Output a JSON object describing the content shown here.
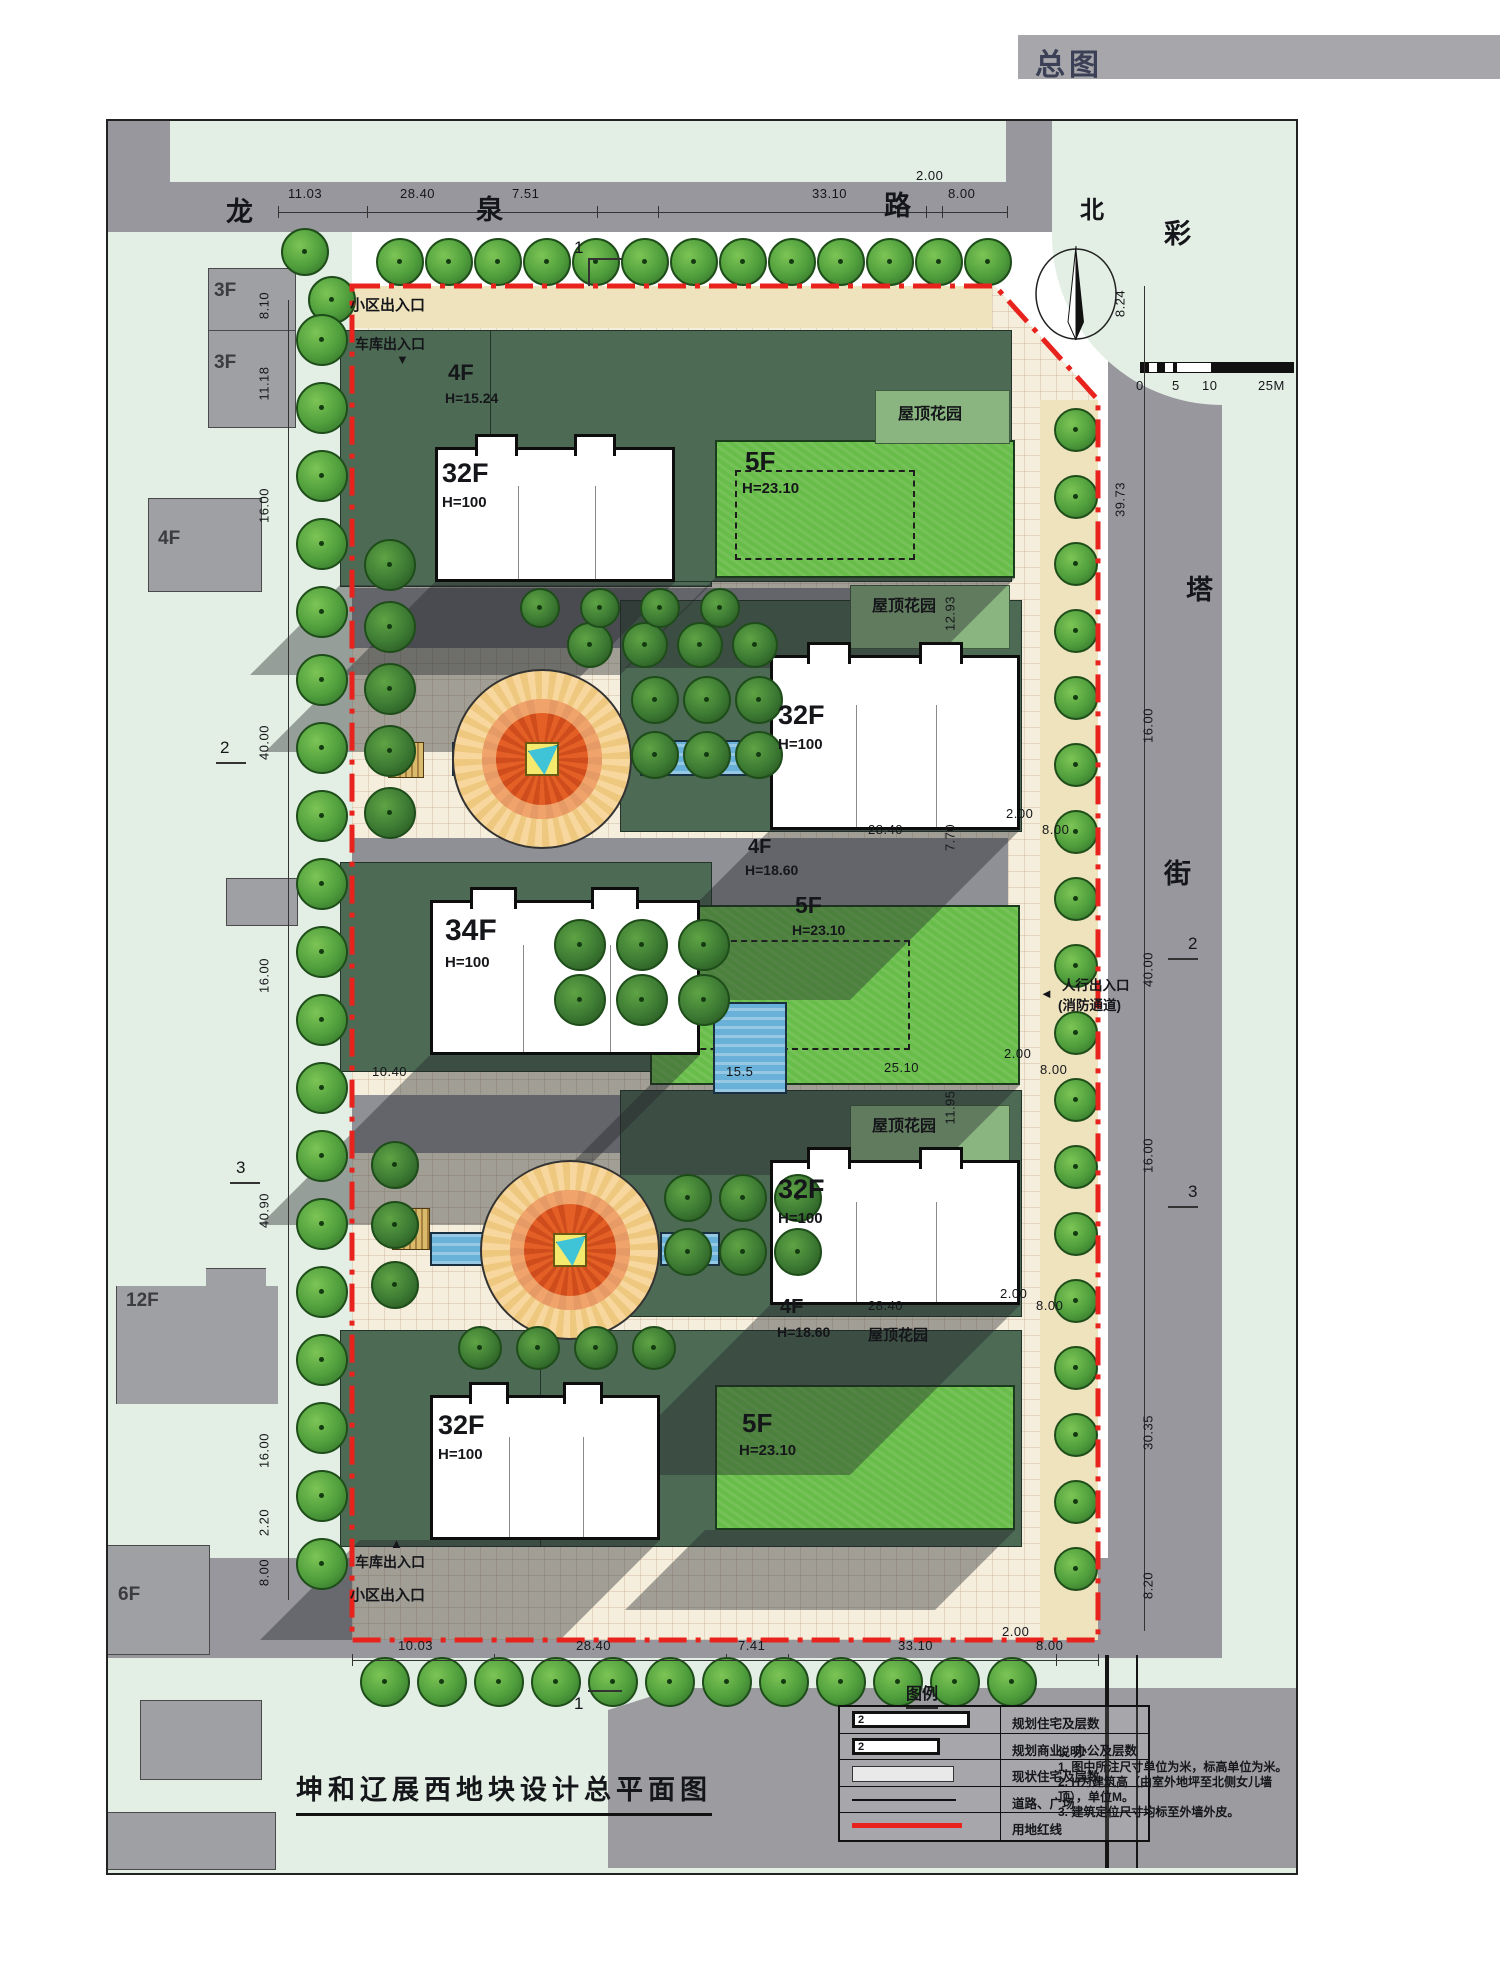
{
  "header": {
    "title": "总图"
  },
  "roads": {
    "top": {
      "name": "龙泉路",
      "chars": [
        "龙",
        "泉",
        "路"
      ]
    },
    "right": {
      "name": "彩塔街",
      "chars": [
        "彩",
        "塔",
        "街"
      ]
    }
  },
  "compass": {
    "north": "北"
  },
  "scalebar": {
    "ticks": [
      "0",
      "5",
      "10",
      "25M"
    ]
  },
  "dims": {
    "top": [
      "11.03",
      "28.40",
      "7.51",
      "33.10",
      "2.00",
      "8.00"
    ],
    "bottom": [
      "10.03",
      "28.40",
      "7.41",
      "33.10",
      "2.00",
      "8.00"
    ],
    "left": [
      "8.10",
      "11.18",
      "16.00",
      "40.00",
      "16.00",
      "40.90",
      "16.00",
      "2.20",
      "8.00"
    ],
    "right": [
      "8.24",
      "39.73",
      "16.00",
      "40.00",
      "16.00",
      "30.35",
      "8.20"
    ],
    "inner_upper": [
      "28.40",
      "7.70",
      "2.00",
      "8.00",
      "12.93"
    ],
    "inner_middle": [
      "10.40",
      "15.5",
      "25.10",
      "2.00",
      "8.00"
    ],
    "inner_lower": [
      "28.40",
      "2.00",
      "8.00",
      "11.95"
    ]
  },
  "sections": {
    "s1": "1",
    "s2": "2",
    "s3": "3"
  },
  "buildings": {
    "tower1": {
      "floors": "32F",
      "height": "H=100"
    },
    "tower2": {
      "floors": "32F",
      "height": "H=100"
    },
    "tower3": {
      "floors": "34F",
      "height": "H=100"
    },
    "tower4": {
      "floors": "32F",
      "height": "H=100"
    },
    "tower5": {
      "floors": "32F",
      "height": "H=100"
    },
    "podium1": {
      "floors": "4F",
      "height": "H=15.24"
    },
    "podium2": {
      "floors": "4F",
      "height": "H=18.60"
    },
    "podium3": {
      "floors": "4F",
      "height": "H=18.60"
    },
    "slab1": {
      "floors": "5F",
      "height": "H=23.10"
    },
    "slab2": {
      "floors": "5F",
      "height": "H=23.10"
    },
    "slab3": {
      "floors": "5F",
      "height": "H=23.10"
    },
    "roof_garden": "屋顶花园"
  },
  "existing": {
    "b1": "3F",
    "b2": "3F",
    "b3": "4F",
    "b4": "12F",
    "b5": "6F"
  },
  "entrances": {
    "community": "小区出入口",
    "garage": "车库出入口",
    "pedestrian": "人行出入口",
    "fire": "(消防通道)",
    "arrow_down": "▼",
    "arrow_up": "▲",
    "arrow_left": "◄"
  },
  "legend": {
    "title": "图例",
    "sample": "2",
    "items": [
      "规划住宅及层数",
      "规划商业、办公及层数",
      "现状住宅及层数",
      "道路、广场",
      "用地红线"
    ]
  },
  "notes": {
    "title": "说明:",
    "items": [
      "1. 图中所注尺寸单位为米，标高单位为米。",
      "2. H为建筑高（由室外地坪至北侧女儿墙顶），单位M。",
      "3. 建筑定位尺寸均标至外墙外皮。"
    ]
  },
  "title_block": {
    "title": "坤和辽展西地块设计总平面图"
  },
  "colors": {
    "red_line": "#e8231d",
    "road": "#97979d",
    "parcel": "#e3efe5",
    "paving": "#f6eedd",
    "slab_green": "#68bd4a",
    "podium_green": "#4d6a55",
    "pool_blue": "#69b1d8",
    "fountain_orange": "#e45f25"
  }
}
